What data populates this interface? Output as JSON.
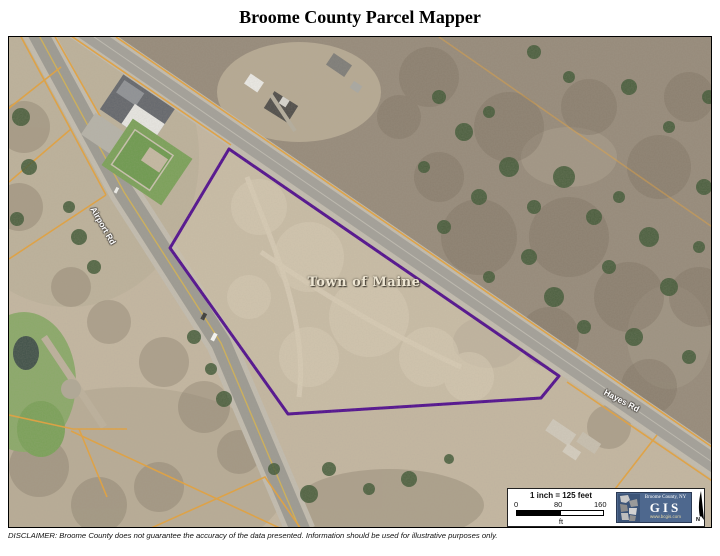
{
  "title": "Broome County Parcel Mapper",
  "map": {
    "town_label": "Town of Maine",
    "road_labels": [
      {
        "text": "Airport Rd"
      },
      {
        "text": "Hayes Rd"
      }
    ]
  },
  "scale": {
    "ratio_label": "1 inch = 125 feet",
    "ticks": [
      "0",
      "80",
      "160"
    ],
    "unit": "ft"
  },
  "logo": {
    "org": "Broome County, NY",
    "acronym": "GIS",
    "url": "www.bcgis.com"
  },
  "north": "N",
  "disclaimer": "DISCLAIMER:  Broome County does not guarantee the accuracy of the data presented.  Information should be used for illustrative purposes only.",
  "colors": {
    "parcel_boundary": "#4f0b8f",
    "parcel_lines": "#e6a23a",
    "logo_background": "#4e688e"
  }
}
